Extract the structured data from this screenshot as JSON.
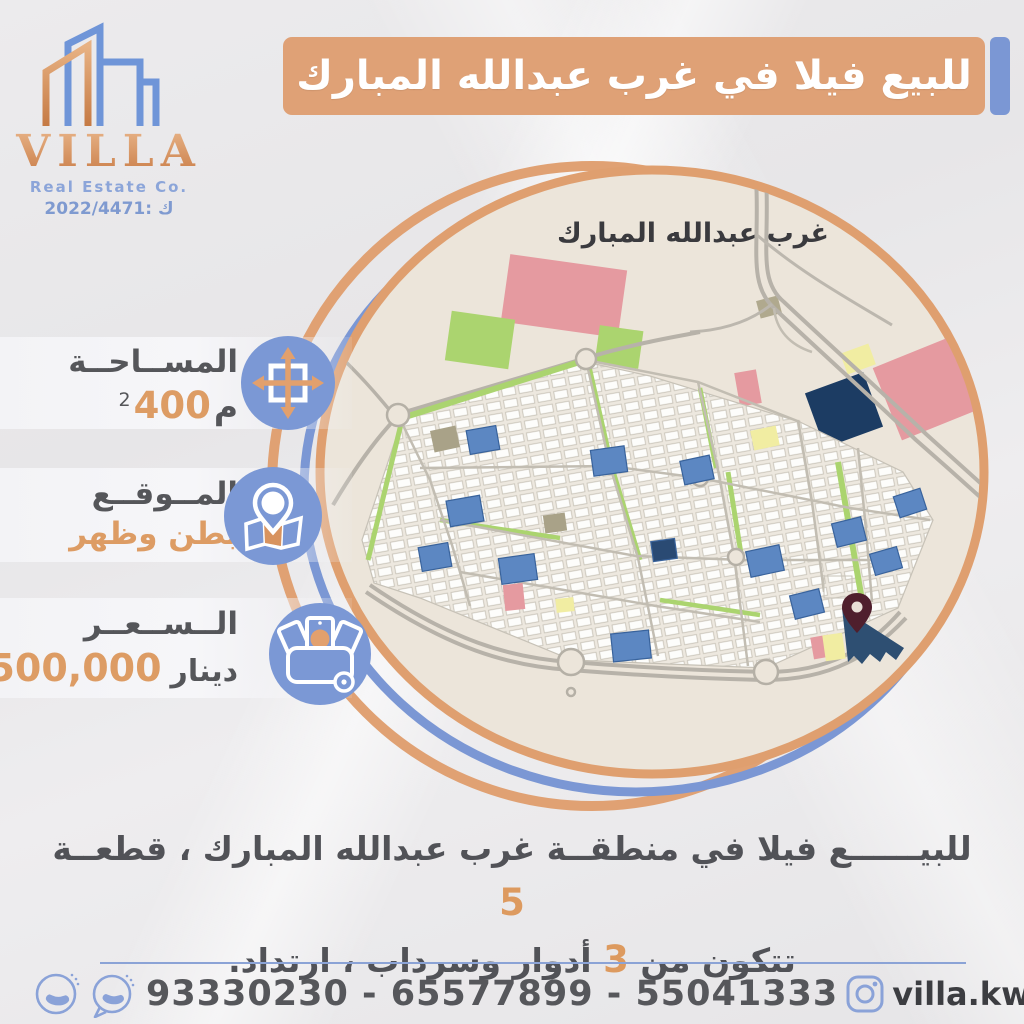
{
  "logo": {
    "name": "VILLA",
    "subtitle": "Real Estate Co.",
    "license": "2022/4471: ك"
  },
  "banner": {
    "title": "للبيع فيلا في غرب عبدالله المبارك"
  },
  "info": {
    "area": {
      "label": "المســاحــة",
      "value": "400",
      "unit": "م",
      "sup": "2"
    },
    "location": {
      "label": "المــوقــع",
      "value": "بطن وظهر"
    },
    "price": {
      "label": "الــســعــر",
      "value": "500,000",
      "unit": "دينار"
    }
  },
  "map": {
    "label": "غرب عبدالله المبارك"
  },
  "description": {
    "line1": "للبيــــــع فيلا في منطقــة غرب عبدالله المبارك ، قطعــة",
    "line1_num": "5",
    "line2_a": "تتكون من",
    "line2_num": "3",
    "line2_b": "أدوار وسرداب ، ارتداد."
  },
  "footer": {
    "phones": "93330230 - 65577899 - 55041333",
    "instagram_handle": "villa.kw",
    "x_snap_handle": "villa_kw"
  },
  "colors": {
    "banner_orange": "#dfa176",
    "accent_blue": "#7b97d4",
    "rim_orange": "#df9f6f",
    "map_beige": "#ece5da",
    "text_dark": "#55565a",
    "value_orange": "#dd9c64",
    "pin_maroon": "#4f1f2d"
  }
}
